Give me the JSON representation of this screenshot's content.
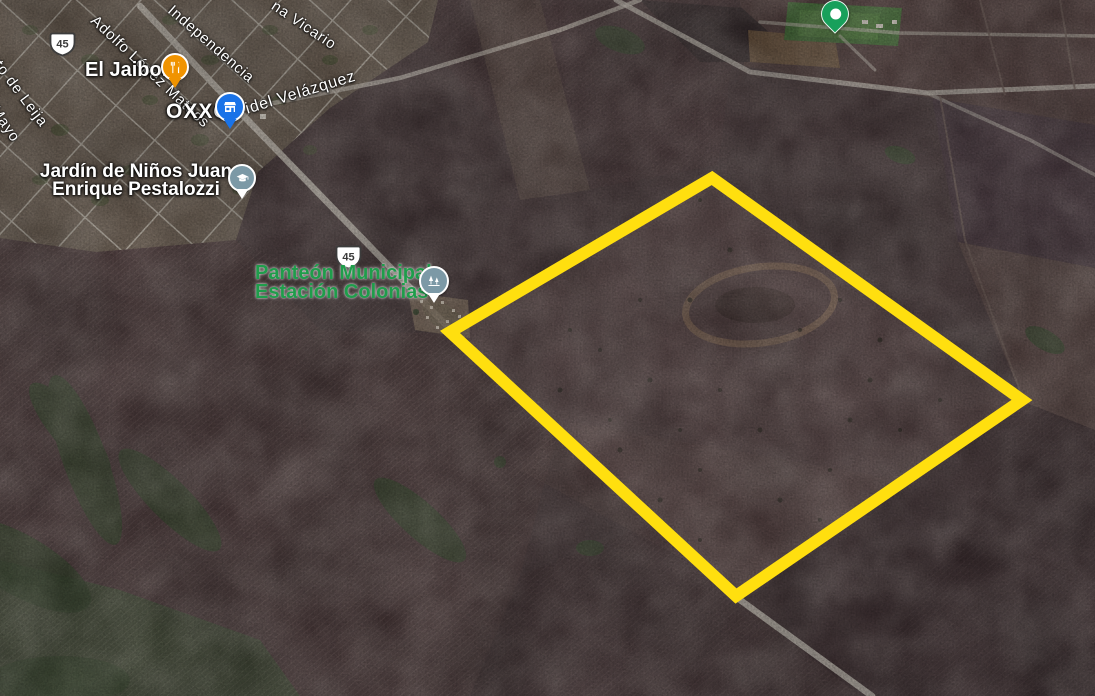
{
  "map": {
    "view": "satellite",
    "route_shields": [
      {
        "number": "45"
      },
      {
        "number": "45"
      }
    ],
    "streets": [
      {
        "text": "Adolfo López Mateos"
      },
      {
        "text": "Independencia"
      },
      {
        "text": "na Vicario"
      },
      {
        "text": "Fidel Velázquez"
      },
      {
        "text": "ato de Leija"
      },
      {
        "text": "Mayo"
      }
    ],
    "pois": [
      {
        "name": "El Jaibon",
        "category": "restaurant",
        "pin_color": "#F09300"
      },
      {
        "name": "OXXO",
        "category": "convenience-store",
        "pin_color": "#1A73E8"
      },
      {
        "line1": "Jardín de Niños Juan",
        "line2": "Enrique Pestalozzi",
        "category": "school",
        "pin_color": "#7C99A6"
      },
      {
        "line1": "Panteón Municipal",
        "line2": "Estación Colonias",
        "category": "cemetery",
        "pin_color": "#7C99A6",
        "label_color": "#1F9D4B"
      }
    ],
    "markers": [
      {
        "type": "place-marker",
        "color": "#18A05B"
      }
    ],
    "parcel_outline": {
      "color": "#FFDF0F",
      "stroke_width": 12,
      "points": [
        [
          712,
          178
        ],
        [
          1022,
          400
        ],
        [
          736,
          596
        ],
        [
          450,
          332
        ]
      ]
    },
    "colors": {
      "road": "#CDC6BB",
      "terrain_base": "#4A3A3C",
      "town_base": "#6F6154"
    }
  }
}
